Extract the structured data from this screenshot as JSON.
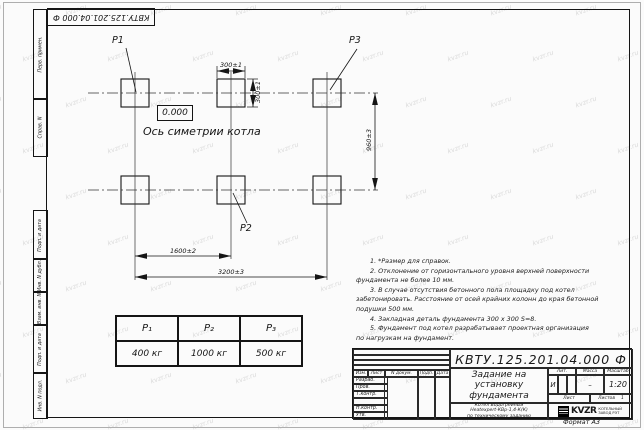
{
  "watermark": {
    "text": "kvzr.ru"
  },
  "sheet": {
    "stamp": "КВТУ.125.201.04.000  Ф",
    "format": "Формат А3"
  },
  "margins": {
    "perv": "Перв. примен.",
    "sprav": "Справ. N",
    "podp1": "Подп. и дата",
    "inv_dubl": "Инв. N дубл.",
    "vzam": "Взам. инв. N",
    "podp2": "Подп. и дата",
    "inv_podl": "Инв. N подл."
  },
  "drawing": {
    "p1": "P1",
    "p2": "P2",
    "p3": "P3",
    "level": "0.000",
    "axis": "Ось симетрии котла",
    "dim_w300": "300±1",
    "dim_h300": "300±1",
    "dim_960": "960±3",
    "dim_1600": "1600±2",
    "dim_3200": "3200±3"
  },
  "notes": {
    "lines": [
      "1. *Размер для справок.",
      "2. Отклонение от горизонтального уровня верхней поверхности",
      "фундамента не более 10 мм.",
      "3. В случае отсутствия бетонного пола площадку под котел",
      "забетонировать. Расстояние от осей крайних колонн до края бетонной",
      "подушки 500 мм.",
      "4. Закладная деталь фундамента  300 x 300 S=8.",
      "5. Фундамент под котел разрабатывает проектная организация",
      "по нагрузкам на фундамент."
    ]
  },
  "load_table": {
    "headers": [
      "P₁",
      "P₂",
      "P₃"
    ],
    "values": [
      "400 кг",
      "1000 кг",
      "500 кг"
    ]
  },
  "title_block": {
    "designation": "КВТУ.125.201.04.000  Ф",
    "doc_title_lines": [
      "Задание на",
      "установку",
      "фундамента"
    ],
    "product_lines": [
      "Котел Водогрейный",
      "Heatexpert-КВр-1,4-К(К)",
      "по техническому заданию"
    ],
    "header_cells": [
      "Изм.",
      "Лист",
      "N докум.",
      "Подп.",
      "Дата"
    ],
    "row_labels": [
      "Разраб.",
      "Пров.",
      "Т.контр.",
      "",
      "Н.контр.",
      "Утв."
    ],
    "lit_label": "Лит.",
    "mass_label": "Масса",
    "scale_label": "Масштаб",
    "lit_value": "И",
    "mass_value": "–",
    "scale_value": "1:20",
    "sheet_label": "Лист",
    "sheets_label": "Листов",
    "sheets_value": "1",
    "company_name": "KVZR",
    "company_sub_lines": [
      "КОТЕЛЬНЫЙ",
      "ЗАВОД РЭТ"
    ]
  }
}
